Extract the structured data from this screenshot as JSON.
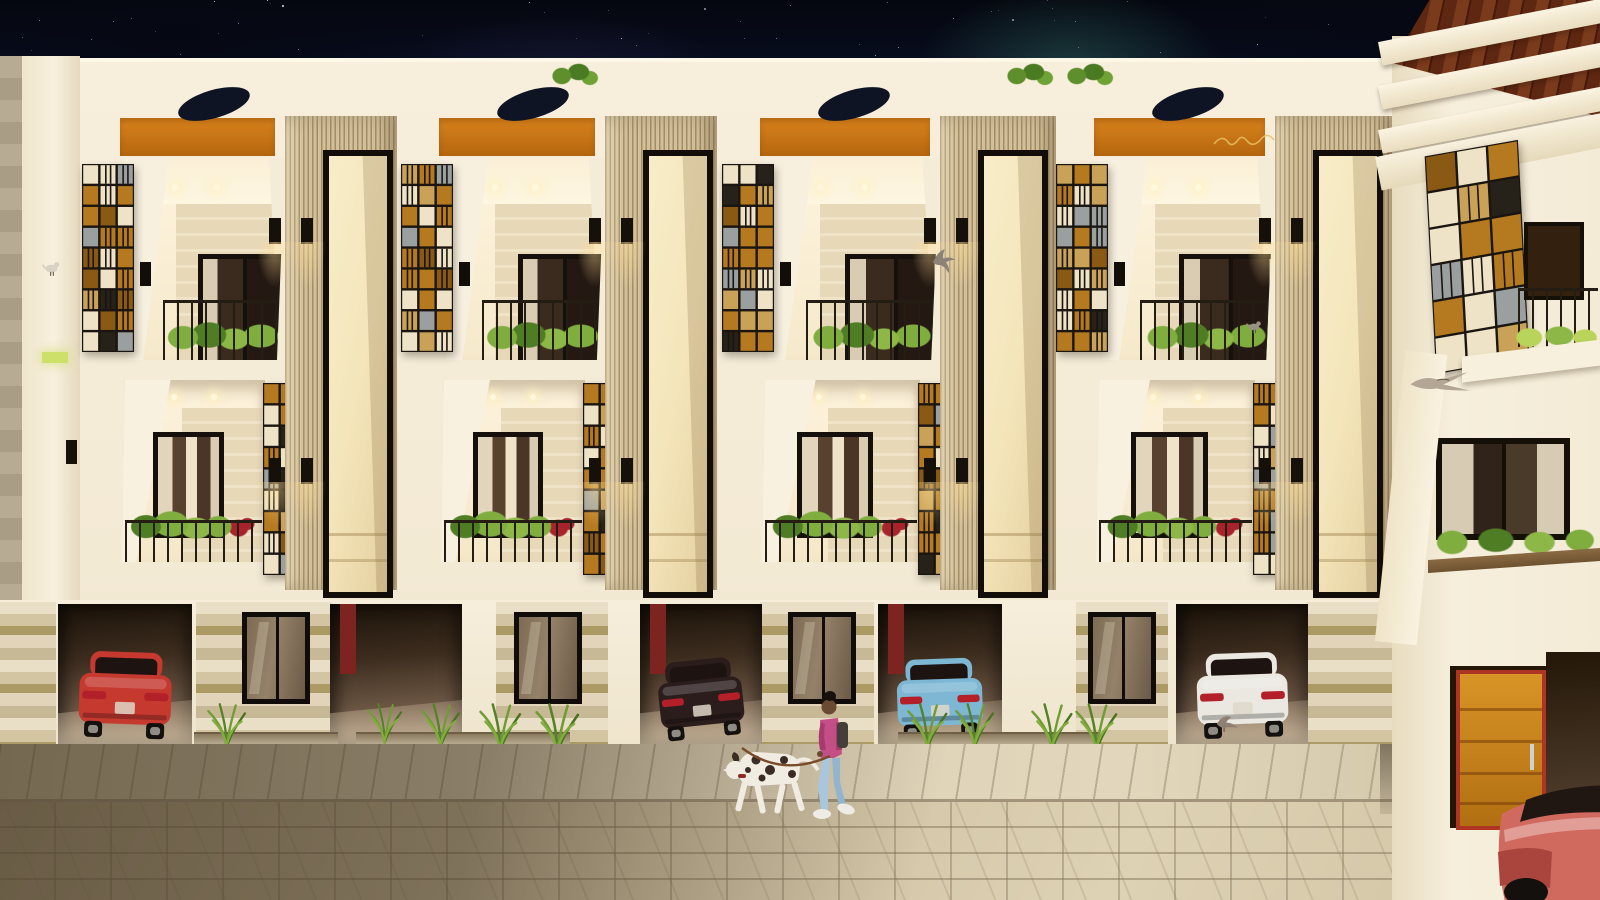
{
  "scene": {
    "description": "Night-time 3D architectural rendering of a modern townhouse row: four identical lit units with stained-glass mosaic screens, fluted slat towers with tall windows, balconies with plants, garages with parked cars, a paved street with a woman walking a dalmatian, pigeons, and an adjacent building with a wood-beam pergola on the right",
    "time_of_day": "night",
    "width": 1600,
    "height": 900
  },
  "palette": {
    "wall_white": "#f6eeda",
    "wall_shade": "#e9ddc2",
    "orange_band": "#d9831d",
    "orange_dark": "#b5660e",
    "slat_light": "#d3c09a",
    "slat_dark": "#a28e66",
    "interior_warm": "#fdf3dc",
    "stone_a": "#e7d8b8",
    "stone_b": "#efe3c8",
    "frame_dark": "#15100b",
    "glass_dark": "#2b1f16",
    "railing": "#241d14",
    "plant_green": "#7fae3f",
    "plant_dark": "#4e7d24",
    "plant_red": "#a8232c",
    "sg_amber": "#b5791f",
    "sg_copper": "#8a5a14",
    "sg_light": "#eee3c6",
    "sg_gray": "#9aa0a0",
    "sg_dark": "#262119",
    "garage_deep": "#1a1209",
    "garage_lit": "#937d66",
    "sidewalk": "#d8cdb2",
    "street": "#cfc1a3",
    "wood_pergola": "#5e2712",
    "wood_pergola_light": "#7a3a1c",
    "door_orange": "#cd8b20",
    "door_frame": "#ae3423",
    "sky_navy": "#0a1330",
    "nebula_teal": "#2d6258"
  },
  "sky": {
    "star_count": 150
  },
  "facade": {
    "units": [
      {
        "x": 78,
        "w": 207
      },
      {
        "x": 397,
        "w": 208
      },
      {
        "x": 718,
        "w": 222
      },
      {
        "x": 1052,
        "w": 223
      }
    ],
    "towers": [
      {
        "x": 285,
        "w": 112
      },
      {
        "x": 605,
        "w": 112
      },
      {
        "x": 940,
        "w": 116
      },
      {
        "x": 1275,
        "w": 118
      }
    ],
    "oval_dx": 135,
    "gold_script_unit_index": 3,
    "roof_plants_x": [
      545,
      1000,
      1060
    ]
  },
  "ground": {
    "garages": [
      {
        "x": 58,
        "w": 134,
        "car": "red",
        "tilt": 2,
        "backdoor": false
      },
      {
        "x": 330,
        "w": 132,
        "car": null,
        "tilt": 0,
        "backdoor": true
      },
      {
        "x": 640,
        "w": 122,
        "car": "dark",
        "tilt": -6,
        "backdoor": true
      },
      {
        "x": 878,
        "w": 124,
        "car": "blue",
        "tilt": -2,
        "backdoor": true
      },
      {
        "x": 1176,
        "w": 132,
        "car": "white",
        "tilt": -2,
        "backdoor": false
      }
    ],
    "piers": [
      {
        "x": 0,
        "w": 56,
        "window": false,
        "wx": 0
      },
      {
        "x": 196,
        "w": 136,
        "window": true,
        "wx": 242
      },
      {
        "x": 496,
        "w": 112,
        "window": true,
        "wx": 514
      },
      {
        "x": 760,
        "w": 114,
        "window": true,
        "wx": 788
      },
      {
        "x": 1076,
        "w": 92,
        "window": true,
        "wx": 1088
      },
      {
        "x": 1306,
        "w": 89,
        "window": false,
        "wx": 0
      }
    ],
    "grass_x": [
      206,
      366,
      420,
      478,
      534,
      906,
      954,
      1030,
      1074,
      1448,
      1502
    ],
    "planters": [
      {
        "x": 194,
        "w": 144
      },
      {
        "x": 356,
        "w": 214
      },
      {
        "x": 898,
        "w": 200
      },
      {
        "x": 1436,
        "w": 92
      }
    ]
  },
  "cars": {
    "red": {
      "color": "#c5392f",
      "type": "sports sedan, rear view"
    },
    "dark": {
      "color": "#2a1d1b",
      "type": "suv hatchback on ramp"
    },
    "blue": {
      "color": "#7db7d3",
      "type": "hatchback, rear view"
    },
    "white": {
      "color": "#ebe8e1",
      "type": "hatchback, rear three-quarter"
    },
    "salmon": {
      "color": "#d06a5f",
      "type": "sedan front corner, street right"
    }
  },
  "right_building": {
    "x": 1392,
    "pergola_beams": 3,
    "has_stained_screen": true,
    "door_color": "#cd8b20",
    "door_frame_color": "#ae3423"
  },
  "left_building": {
    "strip_color": "#b8ab94",
    "accent_light_color": "#cde06a"
  },
  "characters": {
    "woman": {
      "x": 808,
      "y": 692,
      "skin": "#6b4a33",
      "hair": "#17100c",
      "jacket": "#c44f86",
      "jacket_dark": "#a93a6e",
      "jeans": "#a8c6de",
      "shoes": "#efece6",
      "backpack": "#443e3b"
    },
    "dalmatian": {
      "x": 722,
      "y": 740,
      "coat": "#f1ece2",
      "spots": "#3a2c24",
      "leash": "#7a4a2a"
    }
  },
  "birds": [
    {
      "x": 930,
      "y": 248,
      "s": 40,
      "pose": "flying",
      "tint": "#8d8277"
    },
    {
      "x": 1246,
      "y": 318,
      "s": 34,
      "pose": "perched",
      "tint": "#9a9084"
    },
    {
      "x": 1408,
      "y": 368,
      "s": 62,
      "pose": "gliding",
      "tint": "#b3a694"
    },
    {
      "x": 1214,
      "y": 712,
      "s": 40,
      "pose": "ground",
      "tint": "#8d8073"
    },
    {
      "x": 42,
      "y": 258,
      "s": 40,
      "pose": "perched",
      "tint": "#d8d2c4"
    }
  ]
}
